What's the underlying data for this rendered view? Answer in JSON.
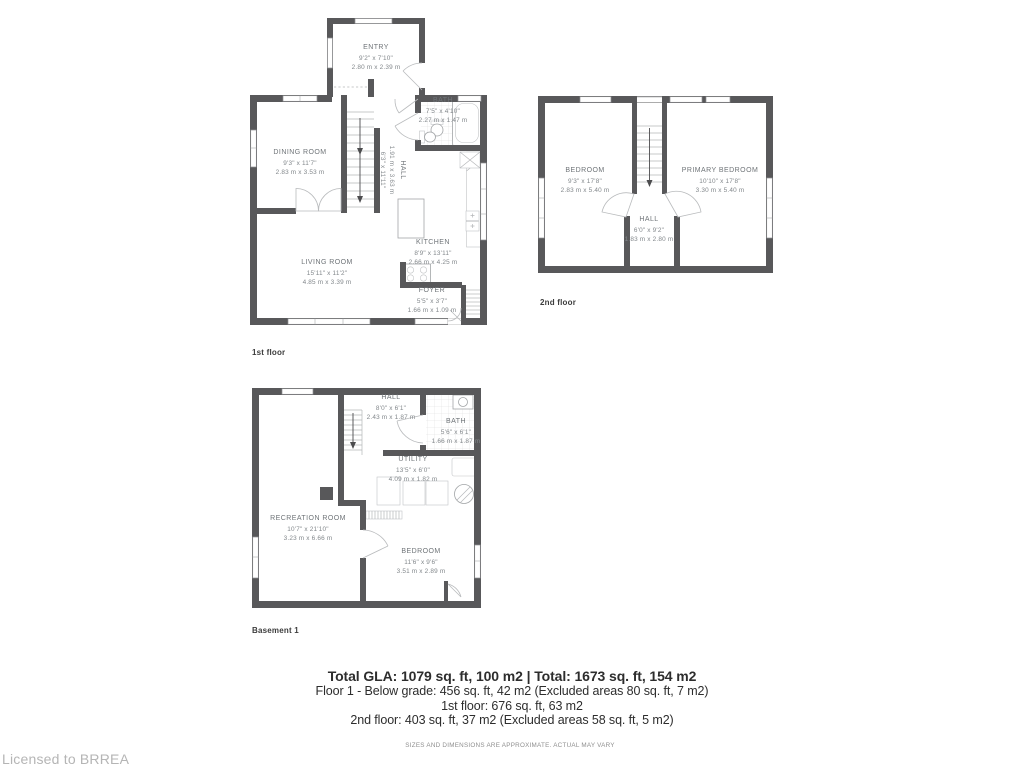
{
  "colors": {
    "wall": "#58585a",
    "accent_text": "#2d2d2d",
    "muted_text": "#82878b"
  },
  "summary": {
    "total": "Total GLA: 1079 sq. ft, 100 m2 | Total: 1673 sq. ft, 154 m2",
    "lines": [
      "Floor 1 - Below grade: 456 sq. ft, 42 m2 (Excluded areas 80 sq. ft, 7 m2)",
      "1st floor: 676 sq. ft, 63 m2",
      "2nd floor: 403 sq. ft, 37 m2 (Excluded areas 58 sq. ft, 5 m2)"
    ]
  },
  "disclaimer": "SIZES AND DIMENSIONS ARE APPROXIMATE. ACTUAL MAY VARY",
  "branding": {
    "license": "Licensed to BRREA"
  },
  "floors": {
    "first": {
      "label": "1st floor",
      "rooms": {
        "entry": {
          "name": "ENTRY",
          "imperial": "9'2\" x 7'10\"",
          "metric": "2.80 m x 2.39 m"
        },
        "dining": {
          "name": "DINING ROOM",
          "imperial": "9'3\" x 11'7\"",
          "metric": "2.83 m x 3.53 m"
        },
        "bath": {
          "name": "BATH",
          "imperial": "7'5\" x 4'10\"",
          "metric": "2.27 m x 1.47 m"
        },
        "hall": {
          "name": "HALL",
          "imperial": "6'3\" x 11'11\"",
          "metric": "1.91 m x 3.63 m"
        },
        "kitchen": {
          "name": "KITCHEN",
          "imperial": "8'9\" x 13'11\"",
          "metric": "2.66 m x 4.25 m"
        },
        "living": {
          "name": "LIVING ROOM",
          "imperial": "15'11\" x 11'2\"",
          "metric": "4.85 m x 3.39 m"
        },
        "foyer": {
          "name": "FOYER",
          "imperial": "5'5\" x 3'7\"",
          "metric": "1.66 m x 1.09 m"
        }
      }
    },
    "second": {
      "label": "2nd floor",
      "rooms": {
        "bedroom": {
          "name": "BEDROOM",
          "imperial": "9'3\" x 17'8\"",
          "metric": "2.83 m x 5.40 m"
        },
        "primary": {
          "name": "PRIMARY BEDROOM",
          "imperial": "10'10\" x 17'8\"",
          "metric": "3.30 m x 5.40 m"
        },
        "hall": {
          "name": "HALL",
          "imperial": "6'0\" x 9'2\"",
          "metric": "1.83 m x 2.80 m"
        }
      }
    },
    "basement": {
      "label": "Basement 1",
      "rooms": {
        "hall": {
          "name": "HALL",
          "imperial": "8'0\" x 6'1\"",
          "metric": "2.43 m x 1.87 m"
        },
        "bath": {
          "name": "BATH",
          "imperial": "5'6\" x 6'1\"",
          "metric": "1.66 m x 1.87 m"
        },
        "utility": {
          "name": "UTILITY",
          "imperial": "13'5\" x 6'0\"",
          "metric": "4.09 m x 1.82 m"
        },
        "recreation": {
          "name": "RECREATION ROOM",
          "imperial": "10'7\" x 21'10\"",
          "metric": "3.23 m x 6.66 m"
        },
        "bedroom": {
          "name": "BEDROOM",
          "imperial": "11'6\" x 9'6\"",
          "metric": "3.51 m x 2.89 m"
        }
      }
    }
  }
}
